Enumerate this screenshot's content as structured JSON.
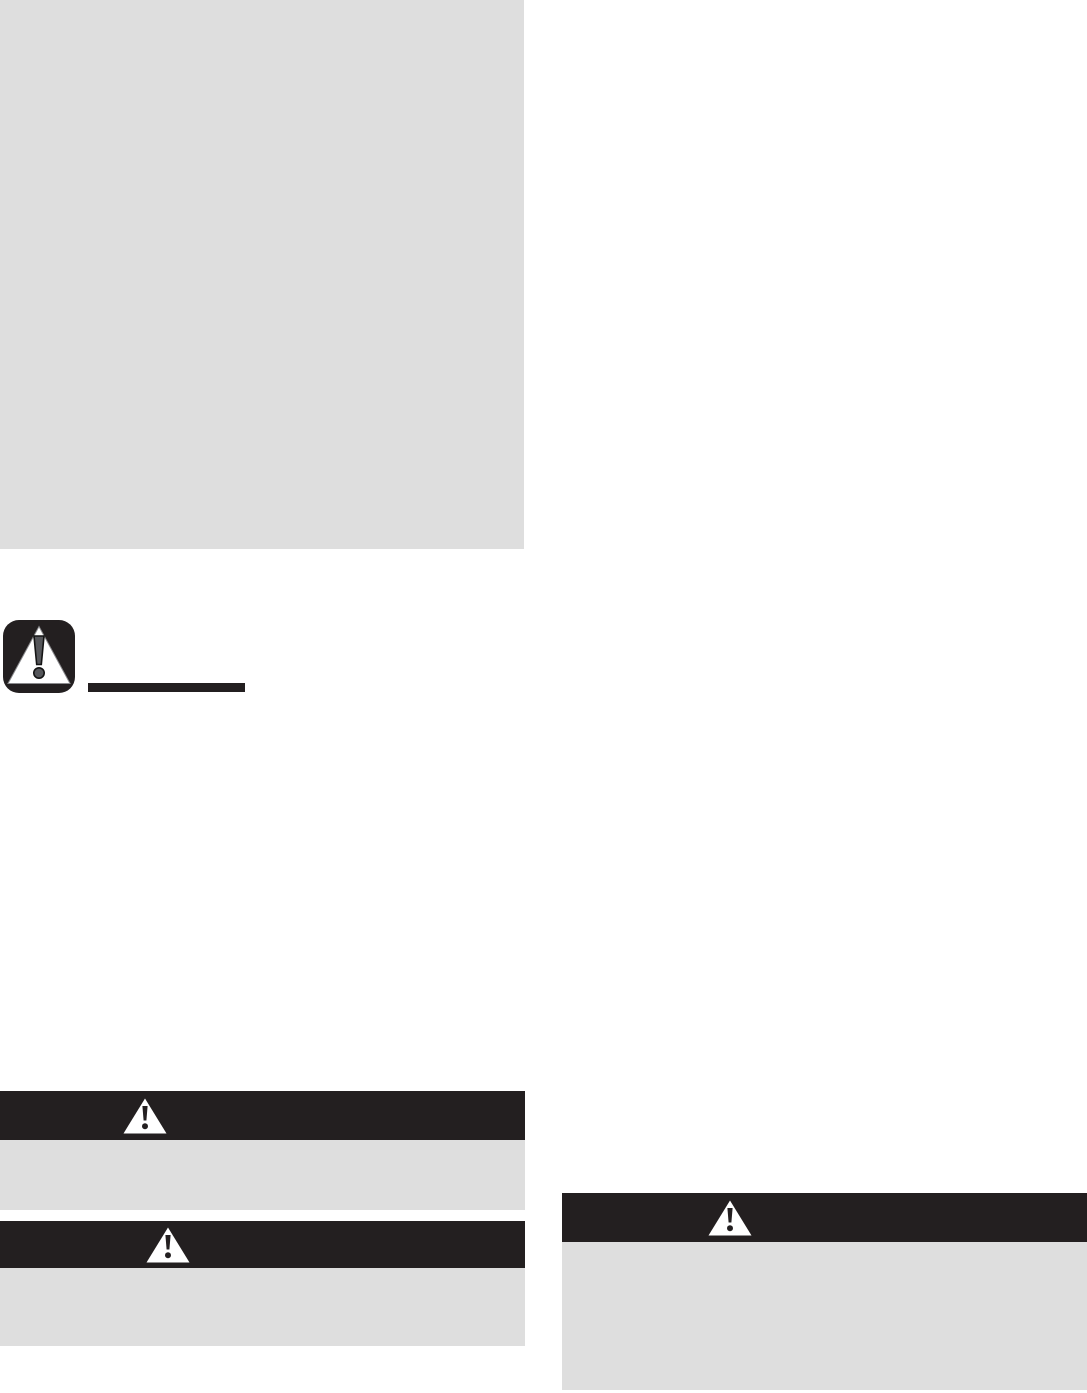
{
  "colors": {
    "page_background": "#ffffff",
    "placeholder_gray": "#dedede",
    "ink_black": "#231f20",
    "exclamation_gray": "#55565a",
    "triangle_white": "#ffffff"
  },
  "image_placeholder": {
    "color": "#dedede"
  },
  "caution_icon": {
    "name": "caution-exclamation-triangle-icon",
    "background_color": "#231f20",
    "triangle_color": "#ffffff",
    "exclamation_color": "#55565a"
  },
  "heading_bar": {
    "color": "#231f20"
  },
  "warning_banners": [
    {
      "id": "warning-banner-left-1",
      "icon": "warning-triangle-icon",
      "header_color": "#231f20",
      "body_color": "#dedede"
    },
    {
      "id": "warning-banner-left-2",
      "icon": "warning-triangle-icon",
      "header_color": "#231f20",
      "body_color": "#dedede"
    },
    {
      "id": "warning-banner-right-1",
      "icon": "warning-triangle-icon",
      "header_color": "#231f20",
      "body_color": "#dedede"
    }
  ]
}
